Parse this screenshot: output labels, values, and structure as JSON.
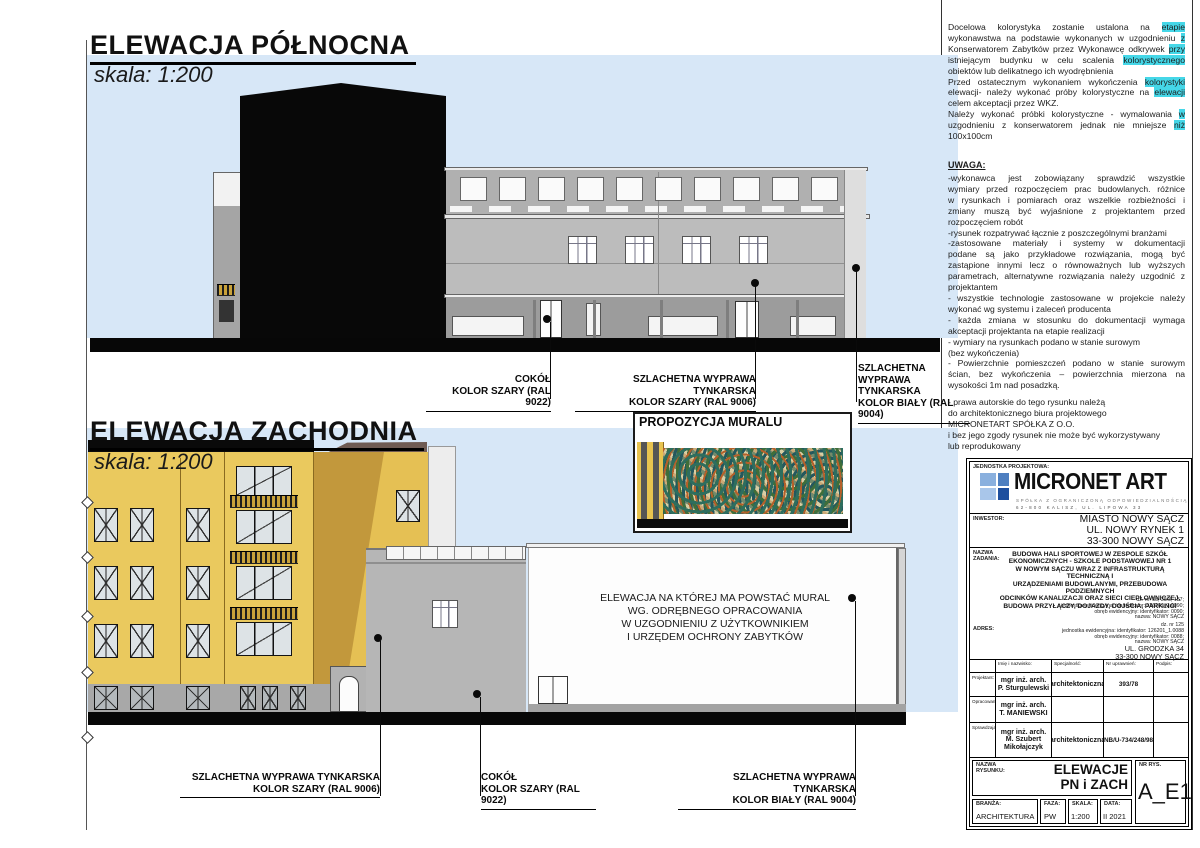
{
  "colors": {
    "sky": "#d7e7f7",
    "facade_yellow": "#eac95e",
    "ground_black": "#0a0a0a",
    "highlight_cyan": "#45d7e8",
    "logo_blue_dark": "#1e4f9e",
    "logo_blue_light": "#8ab0de",
    "mural_teal": "#2e6e5e"
  },
  "north": {
    "title": "ELEWACJA PÓŁNOCNA",
    "scale": "skala: 1:200",
    "labels": {
      "cokol": "COKÓŁ\nKOLOR SZARY (RAL 9022)",
      "szary": "SZLACHETNA WYPRAWA TYNKARSKA\nKOLOR SZARY (RAL 9006)",
      "bialy": "SZLACHETNA WYPRAWA\nTYNKARSKA\nKOLOR BIAŁY (RAL 9004)"
    }
  },
  "west": {
    "title": "ELEWACJA ZACHODNIA",
    "scale": "skala: 1:200",
    "mural_title": "PROPOZYCJA MURALU",
    "wall_note": "ELEWACJA NA KTÓREJ MA POWSTAĆ MURAL\nWG. ODRĘBNEGO OPRACOWANIA\nW UZGODNIENIU Z UŻYTKOWNIKIEM\nI URZĘDEM OCHRONY ZABYTKÓW",
    "labels": {
      "szary": "SZLACHETNA WYPRAWA TYNKARSKA\nKOLOR SZARY (RAL 9006)",
      "cokol": "COKÓŁ\nKOLOR SZARY (RAL 9022)",
      "bialy": "SZLACHETNA WYPRAWA TYNKARSKA\nKOLOR BIAŁY (RAL 9004)"
    }
  },
  "notes": {
    "colors_note_lines": [
      {
        "j": true,
        "s": [
          {
            "t": "Docelowa kolorystyka zostanie ustalona na "
          },
          {
            "t": "etapie",
            "h": true
          }
        ]
      },
      {
        "j": true,
        "s": [
          {
            "t": "wykonawstwa na podstawie wykonanych w uzgodnieniu "
          },
          {
            "t": "z",
            "h": true
          }
        ]
      },
      {
        "j": true,
        "s": [
          {
            "t": "Konserwatorem Zabytków przez Wykonawcę odkrywek "
          },
          {
            "t": "przy",
            "h": true
          }
        ]
      },
      {
        "j": true,
        "s": [
          {
            "t": "istniejącym budynku w celu scalenia "
          },
          {
            "t": "kolorystycznego",
            "h": true
          }
        ]
      },
      {
        "s": [
          {
            "t": "obiektów lub delikatnego ich wyodrębnienia"
          }
        ]
      },
      {
        "j": true,
        "s": [
          {
            "t": "Przed ostatecznym wykonaniem wykończenia "
          },
          {
            "t": "kolorystyki",
            "h": true
          }
        ]
      },
      {
        "j": true,
        "s": [
          {
            "t": "elewacji- należy wykonać próby kolorystyczne na "
          },
          {
            "t": "elewacji",
            "h": true
          }
        ]
      },
      {
        "s": [
          {
            "t": "celem akceptacji przez WKZ."
          }
        ]
      },
      {
        "j": true,
        "s": [
          {
            "t": "Należy wykonać próbki kolorystyczne - wymalowania "
          },
          {
            "t": "w",
            "h": true
          }
        ]
      },
      {
        "j": true,
        "s": [
          {
            "t": "uzgodnieniu z konserwatorem jednak nie mniejsze "
          },
          {
            "t": "niż",
            "h": true
          }
        ]
      },
      {
        "s": [
          {
            "t": "100x100cm"
          }
        ]
      }
    ],
    "uwaga_title": "UWAGA:",
    "uwaga_lines": [
      {
        "j": true,
        "s": [
          {
            "t": "-wykonawca jest zobowiązany sprawdzić wszystkie"
          }
        ]
      },
      {
        "j": true,
        "s": [
          {
            "t": "wymiary przed rozpoczęciem prac budowlanych. różnice"
          }
        ]
      },
      {
        "j": true,
        "s": [
          {
            "t": "w rysunkach i pomiarach oraz wszelkie rozbieżności i"
          }
        ]
      },
      {
        "j": true,
        "s": [
          {
            "t": "zmiany muszą być wyjaśnione z projektantem przed"
          }
        ]
      },
      {
        "s": [
          {
            "t": "rozpoczęciem robót"
          }
        ]
      },
      {
        "s": [
          {
            "t": "-rysunek rozpatrywać łącznie z poszczególnymi branżami"
          }
        ]
      },
      {
        "j": true,
        "s": [
          {
            "t": "-zastosowane materiały i systemy w dokumentacji"
          }
        ]
      },
      {
        "j": true,
        "s": [
          {
            "t": "podane są jako przykładowe rozwiązania, mogą być"
          }
        ]
      },
      {
        "j": true,
        "s": [
          {
            "t": "zastąpione innymi lecz o równoważnych lub wyższych"
          }
        ]
      },
      {
        "j": true,
        "s": [
          {
            "t": "parametrach, alternatywne rozwiązania należy uzgodnić z"
          }
        ]
      },
      {
        "s": [
          {
            "t": "projektantem"
          }
        ]
      },
      {
        "j": true,
        "s": [
          {
            "t": "- wszystkie technologie zastosowane w projekcie należy"
          }
        ]
      },
      {
        "s": [
          {
            "t": "wykonać wg systemu i zaleceń producenta"
          }
        ]
      },
      {
        "j": true,
        "s": [
          {
            "t": "- każda zmiana w stosunku do dokumentacji wymaga"
          }
        ]
      },
      {
        "s": [
          {
            "t": "akceptacji projektanta na etapie realizacji"
          }
        ]
      },
      {
        "s": [
          {
            "t": "- wymiary na rysunkach podano w stanie surowym"
          }
        ]
      },
      {
        "s": [
          {
            "t": "(bez wykończenia)"
          }
        ]
      },
      {
        "j": true,
        "s": [
          {
            "t": "- Powierzchnie pomieszczeń podano w stanie surowym"
          }
        ]
      },
      {
        "j": true,
        "s": [
          {
            "t": "ścian, bez wykończenia – powierzchnia mierzona na"
          }
        ]
      },
      {
        "s": [
          {
            "t": "wysokości 1m nad posadzką."
          }
        ]
      }
    ],
    "copyright_lines": [
      {
        "s": [
          {
            "t": "- prawa autorskie do tego rysunku należą"
          }
        ]
      },
      {
        "s": [
          {
            "t": "do architektonicznego biura projektowego"
          }
        ]
      },
      {
        "s": [
          {
            "t": "MICRONETART SPÓŁKA Z O.O."
          }
        ]
      },
      {
        "s": [
          {
            "t": "i bez jego zgody rysunek nie może być wykorzystywany"
          }
        ]
      },
      {
        "s": [
          {
            "t": "lub reprodukowany"
          }
        ]
      }
    ]
  },
  "titleblock": {
    "jednostka_label": "JEDNOSTKA PROJEKTOWA:",
    "logo_text": "MICRONET ART",
    "logo_sub1": "SPÓŁKA Z OGRANICZONĄ ODPOWIEDZIALNOŚCIĄ",
    "logo_sub2": "62-800 KALISZ, UL. LIPOWA 33",
    "inwestor_label": "INWESTOR:",
    "inwestor_value": "MIASTO NOWY SĄCZ\nUL. NOWY RYNEK 1\n33-300 NOWY SĄCZ",
    "nazwa_label": "NAZWA\nZADANIA:",
    "nazwa_value": "BUDOWA HALI SPORTOWEJ W ZESPOLE SZKÓŁ\nEKONOMICZNYCH - SZKOLE PODSTAWOWEJ NR 1\nW NOWYM SĄCZU WRAZ Z INFRASTRUKTURĄ TECHNICZNĄ I\nURZĄDZENIAMI BUDOWLANYMI, PRZEBUDOWA PODZIEMNYCH\nODCINKÓW KANALIZACJI ORAZ SIECI CIEPŁOWNICZEJ,\nBUDOWA PRZYŁĄCZY, DOJAZDY, DOJŚCIA, PARKINGI",
    "dz1": "dz. nr: 35, 39/3, 137;\njednostka ewidencyjna: identyfikator: 126201_1.0090;\nobręb ewidencyjny: identyfikator: 0090;\nnazwa: NOWY SĄCZ",
    "adres_label": "ADRES:",
    "dz2": "dz. nr 125\njednostka ewidencyjna: identyfikator: 126201_1.0088\nobręb ewidencyjny: identyfikator: 0088;\nnazwa: NOWY SĄCZ",
    "adres_value": "UL. GRODZKA 34\n33-300 NOWY SĄCZ",
    "table": {
      "headers": [
        "Imię i nazwisko:",
        "Specjalność:",
        "Nr uprawnień:",
        "Podpis:"
      ],
      "rows": [
        {
          "role": "Projektant:",
          "name": "mgr inż. arch.\nP. Sturgulewski",
          "spec": "architektoniczna",
          "nr": "393/78",
          "podpis": ""
        },
        {
          "role": "Opracowanie:",
          "name": "mgr inż. arch.\nT. MANIEWSKI",
          "spec": "",
          "nr": "",
          "podpis": ""
        },
        {
          "role": "Sprawdzający:",
          "name": "mgr inż. arch.\nM. Szubert\nMikołajczyk",
          "spec": "architektoniczna",
          "nr": "NB/U-734/248/98",
          "podpis": ""
        }
      ]
    },
    "nazwa_rys_label": "NAZWA\nRYSUNKU:",
    "nazwa_rys_value": "ELEWACJE\nPN i ZACH",
    "nr_rys_label": "NR RYS.",
    "nr_rys_value": "A_E1",
    "branza_label": "BRANŻA:",
    "branza_value": "ARCHITEKTURA",
    "faza_label": "FAZA:",
    "faza_value": "PW",
    "skala_label": "SKALA:",
    "skala_value": "1:200",
    "data_label": "DATA:",
    "data_value": "II 2021"
  }
}
